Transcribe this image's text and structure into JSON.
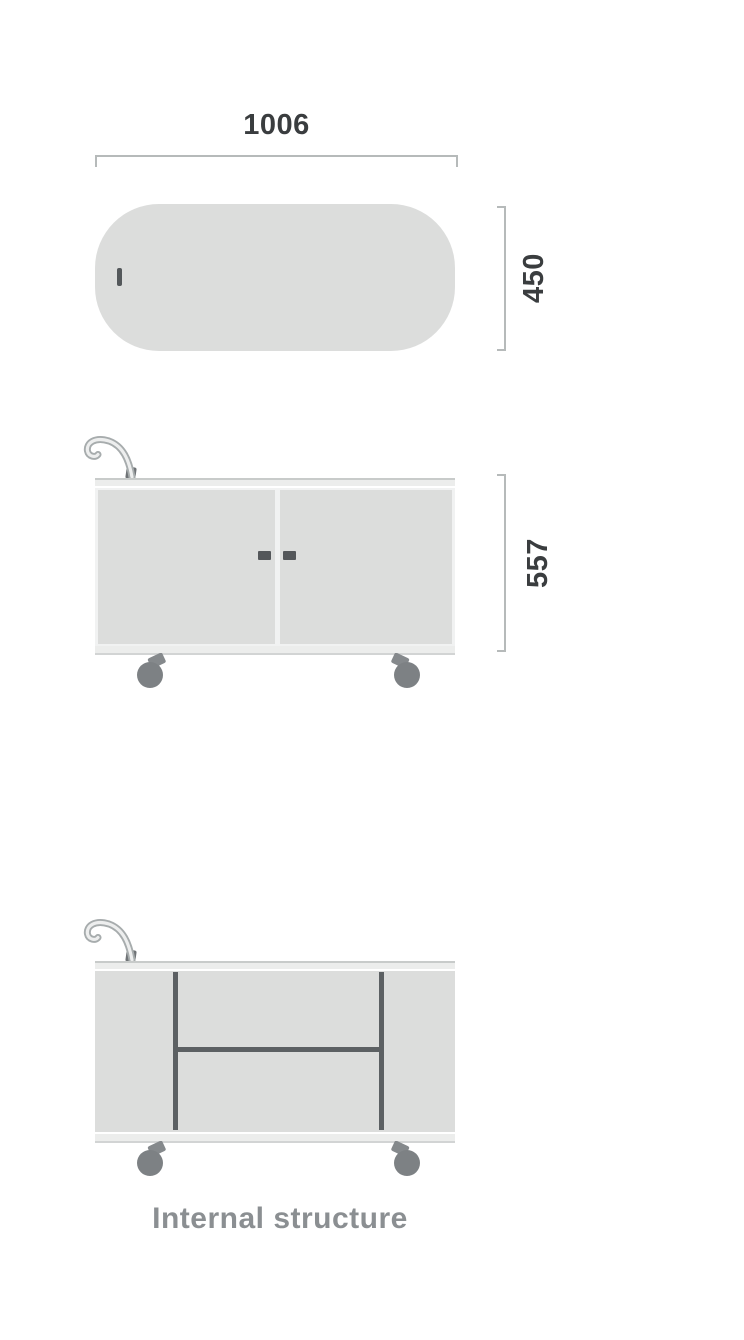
{
  "diagram": {
    "title": "product-dimension-diagram",
    "views": {
      "top": {
        "name": "top-view",
        "width_dimension": "1006",
        "depth_dimension": "450"
      },
      "front": {
        "name": "front-view",
        "height_dimension": "557"
      },
      "internal": {
        "name": "internal-structure-view",
        "caption": "Internal structure"
      }
    },
    "colors": {
      "panel_fill": "#dcdddc",
      "frame_fill": "#ecedec",
      "body_gap_fill": "#f1f2f2",
      "dimension_line": "#b6baba",
      "dimension_text": "#3a3d3f",
      "divider": "#5c6063",
      "caster_wheel": "#7d8184",
      "caster_bracket": "#85898c",
      "handle_tube_outline": "#a7acad",
      "handle_tube_fill": "#edeeee",
      "handle_base": "#6f7376",
      "door_handle": "#54575a",
      "caption_text": "#8b8f92",
      "background": "#ffffff"
    }
  }
}
